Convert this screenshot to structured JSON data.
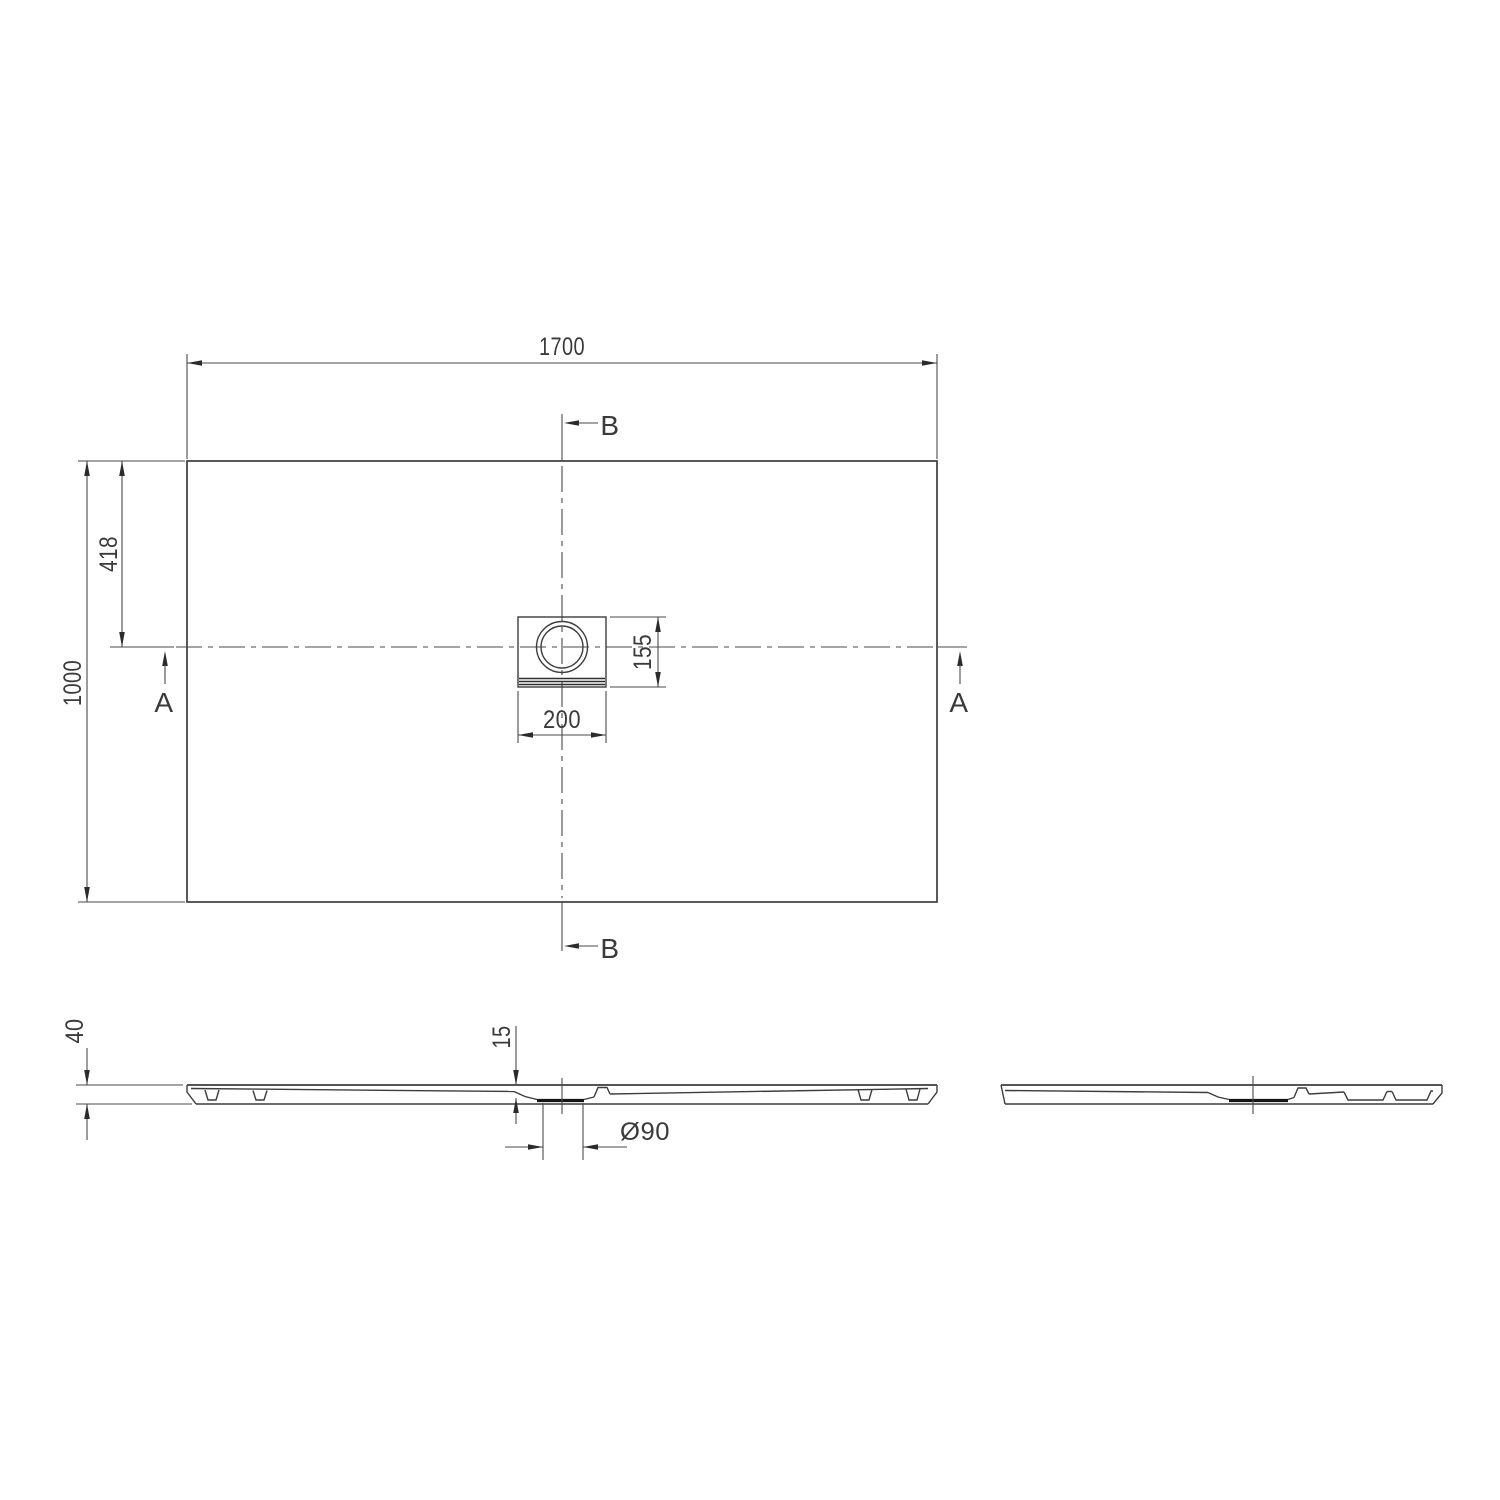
{
  "drawing": {
    "type": "technical-drawing",
    "subject": "rectangular shower tray with central square drain, plan view and two cross sections",
    "labels": {
      "plan_width": "1700",
      "plan_depth": "1000",
      "drain_offset_from_edge": "418",
      "drain_cutout_width": "200",
      "drain_cutout_depth": "155",
      "section_marker_a": "A",
      "section_marker_b": "B",
      "tray_height": "40",
      "drain_recess_depth": "15",
      "drain_diameter": "Ø90"
    },
    "colors": {
      "background": "#ffffff",
      "object_line": "#3d3d3d",
      "dimension_line": "#4a4a4a",
      "drain_accent": "#161616",
      "text": "#3a3a3a"
    }
  }
}
